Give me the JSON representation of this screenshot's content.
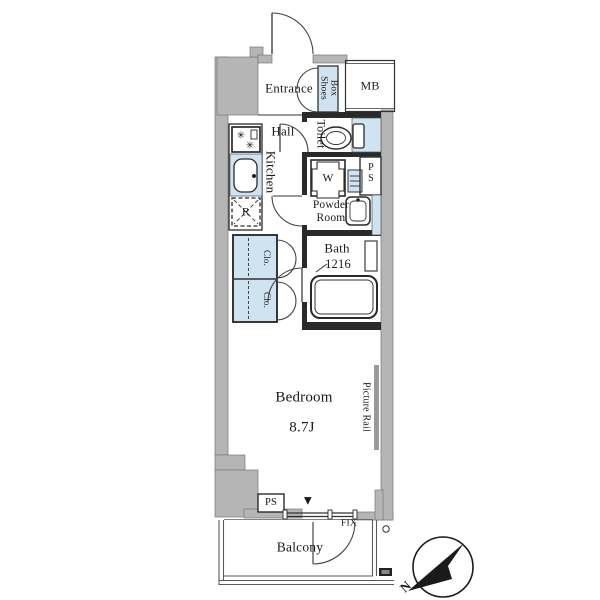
{
  "plan": {
    "rooms": {
      "entrance": "Entrance",
      "shoes_box_l1": "Shoes",
      "shoes_box_l2": "Box",
      "mb": "MB",
      "hall": "Hall",
      "kitchen": "Kitchen",
      "toilet": "Toilet",
      "washer": "W",
      "pipe_space_upper": "P\nS",
      "powder_room": "Powder\nRoom",
      "bath": "Bath",
      "bath_size": "1216",
      "closet_upper": "Clo.",
      "closet_lower": "Clo.",
      "refrigerator": "R",
      "bedroom": "Bedroom",
      "bedroom_size": "8.7J",
      "picture_rail": "Picture Rail",
      "pipe_space_lower": "PS",
      "fixed_window": "FIX",
      "balcony": "Balcony"
    },
    "icons": {
      "window_marker": "▼",
      "stove_burner": "✳"
    },
    "compass": {
      "north_label": "N"
    },
    "colors": {
      "fixture_blue": "#cfe3f0",
      "wall_gray": "#b5b5b5",
      "line": "#1a1a1a",
      "balcony_line": "#5a5a5a"
    }
  }
}
